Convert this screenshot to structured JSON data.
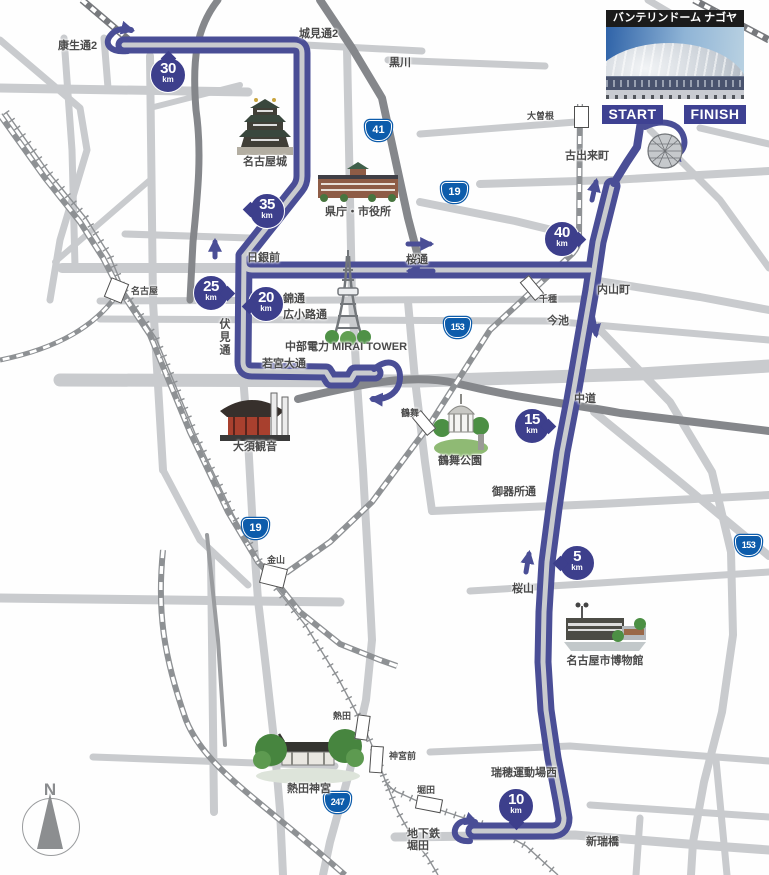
{
  "dome_card": {
    "title": "バンテリンドーム ナゴヤ"
  },
  "course": {
    "start": "START",
    "finish": "FINISH"
  },
  "km_markers": [
    {
      "value": "5",
      "unit": "km"
    },
    {
      "value": "10",
      "unit": "km"
    },
    {
      "value": "15",
      "unit": "km"
    },
    {
      "value": "20",
      "unit": "km"
    },
    {
      "value": "25",
      "unit": "km"
    },
    {
      "value": "30",
      "unit": "km"
    },
    {
      "value": "35",
      "unit": "km"
    },
    {
      "value": "40",
      "unit": "km"
    }
  ],
  "route_badges": [
    {
      "number": "41"
    },
    {
      "number": "19"
    },
    {
      "number": "153"
    },
    {
      "number": "19"
    },
    {
      "number": "153"
    },
    {
      "number": "247"
    }
  ],
  "stations": [
    {
      "name": "名古屋"
    },
    {
      "name": "金山"
    },
    {
      "name": "大曽根"
    },
    {
      "name": "千種"
    },
    {
      "name": "鶴舞"
    },
    {
      "name": "熱田"
    },
    {
      "name": "神宮前"
    },
    {
      "name": "堀田"
    }
  ],
  "streets": [
    {
      "name": "康生通2"
    },
    {
      "name": "城見通2"
    },
    {
      "name": "黒川"
    },
    {
      "name": "古出来町"
    },
    {
      "name": "日銀前"
    },
    {
      "name": "桜通"
    },
    {
      "name": "内山町"
    },
    {
      "name": "今池"
    },
    {
      "name": "錦通"
    },
    {
      "name": "広小路通"
    },
    {
      "name": "伏見通"
    },
    {
      "name": "若宮大通"
    },
    {
      "name": "中道"
    },
    {
      "name": "御器所通"
    },
    {
      "name": "桜山"
    },
    {
      "name": "瑞穂運動場西"
    },
    {
      "name": "新瑞橋"
    },
    {
      "name": "地下鉄\n堀田"
    }
  ],
  "landmarks": [
    {
      "name": "名古屋城"
    },
    {
      "name": "県庁・市役所"
    },
    {
      "name": "中部電力 MIRAI TOWER"
    },
    {
      "name": "大須観音"
    },
    {
      "name": "鶴舞公園"
    },
    {
      "name": "名古屋市博物館"
    },
    {
      "name": "熱田神宮"
    }
  ],
  "compass": {
    "label": "N"
  },
  "colors": {
    "course": "#4a4e96",
    "road": "#c9cbce",
    "road_dark": "#85878b",
    "railway": "#8e9194",
    "km_marker": "#3d3f8c",
    "route_badge": "#0d5cab",
    "start_finish_bg": "#3e4192"
  }
}
